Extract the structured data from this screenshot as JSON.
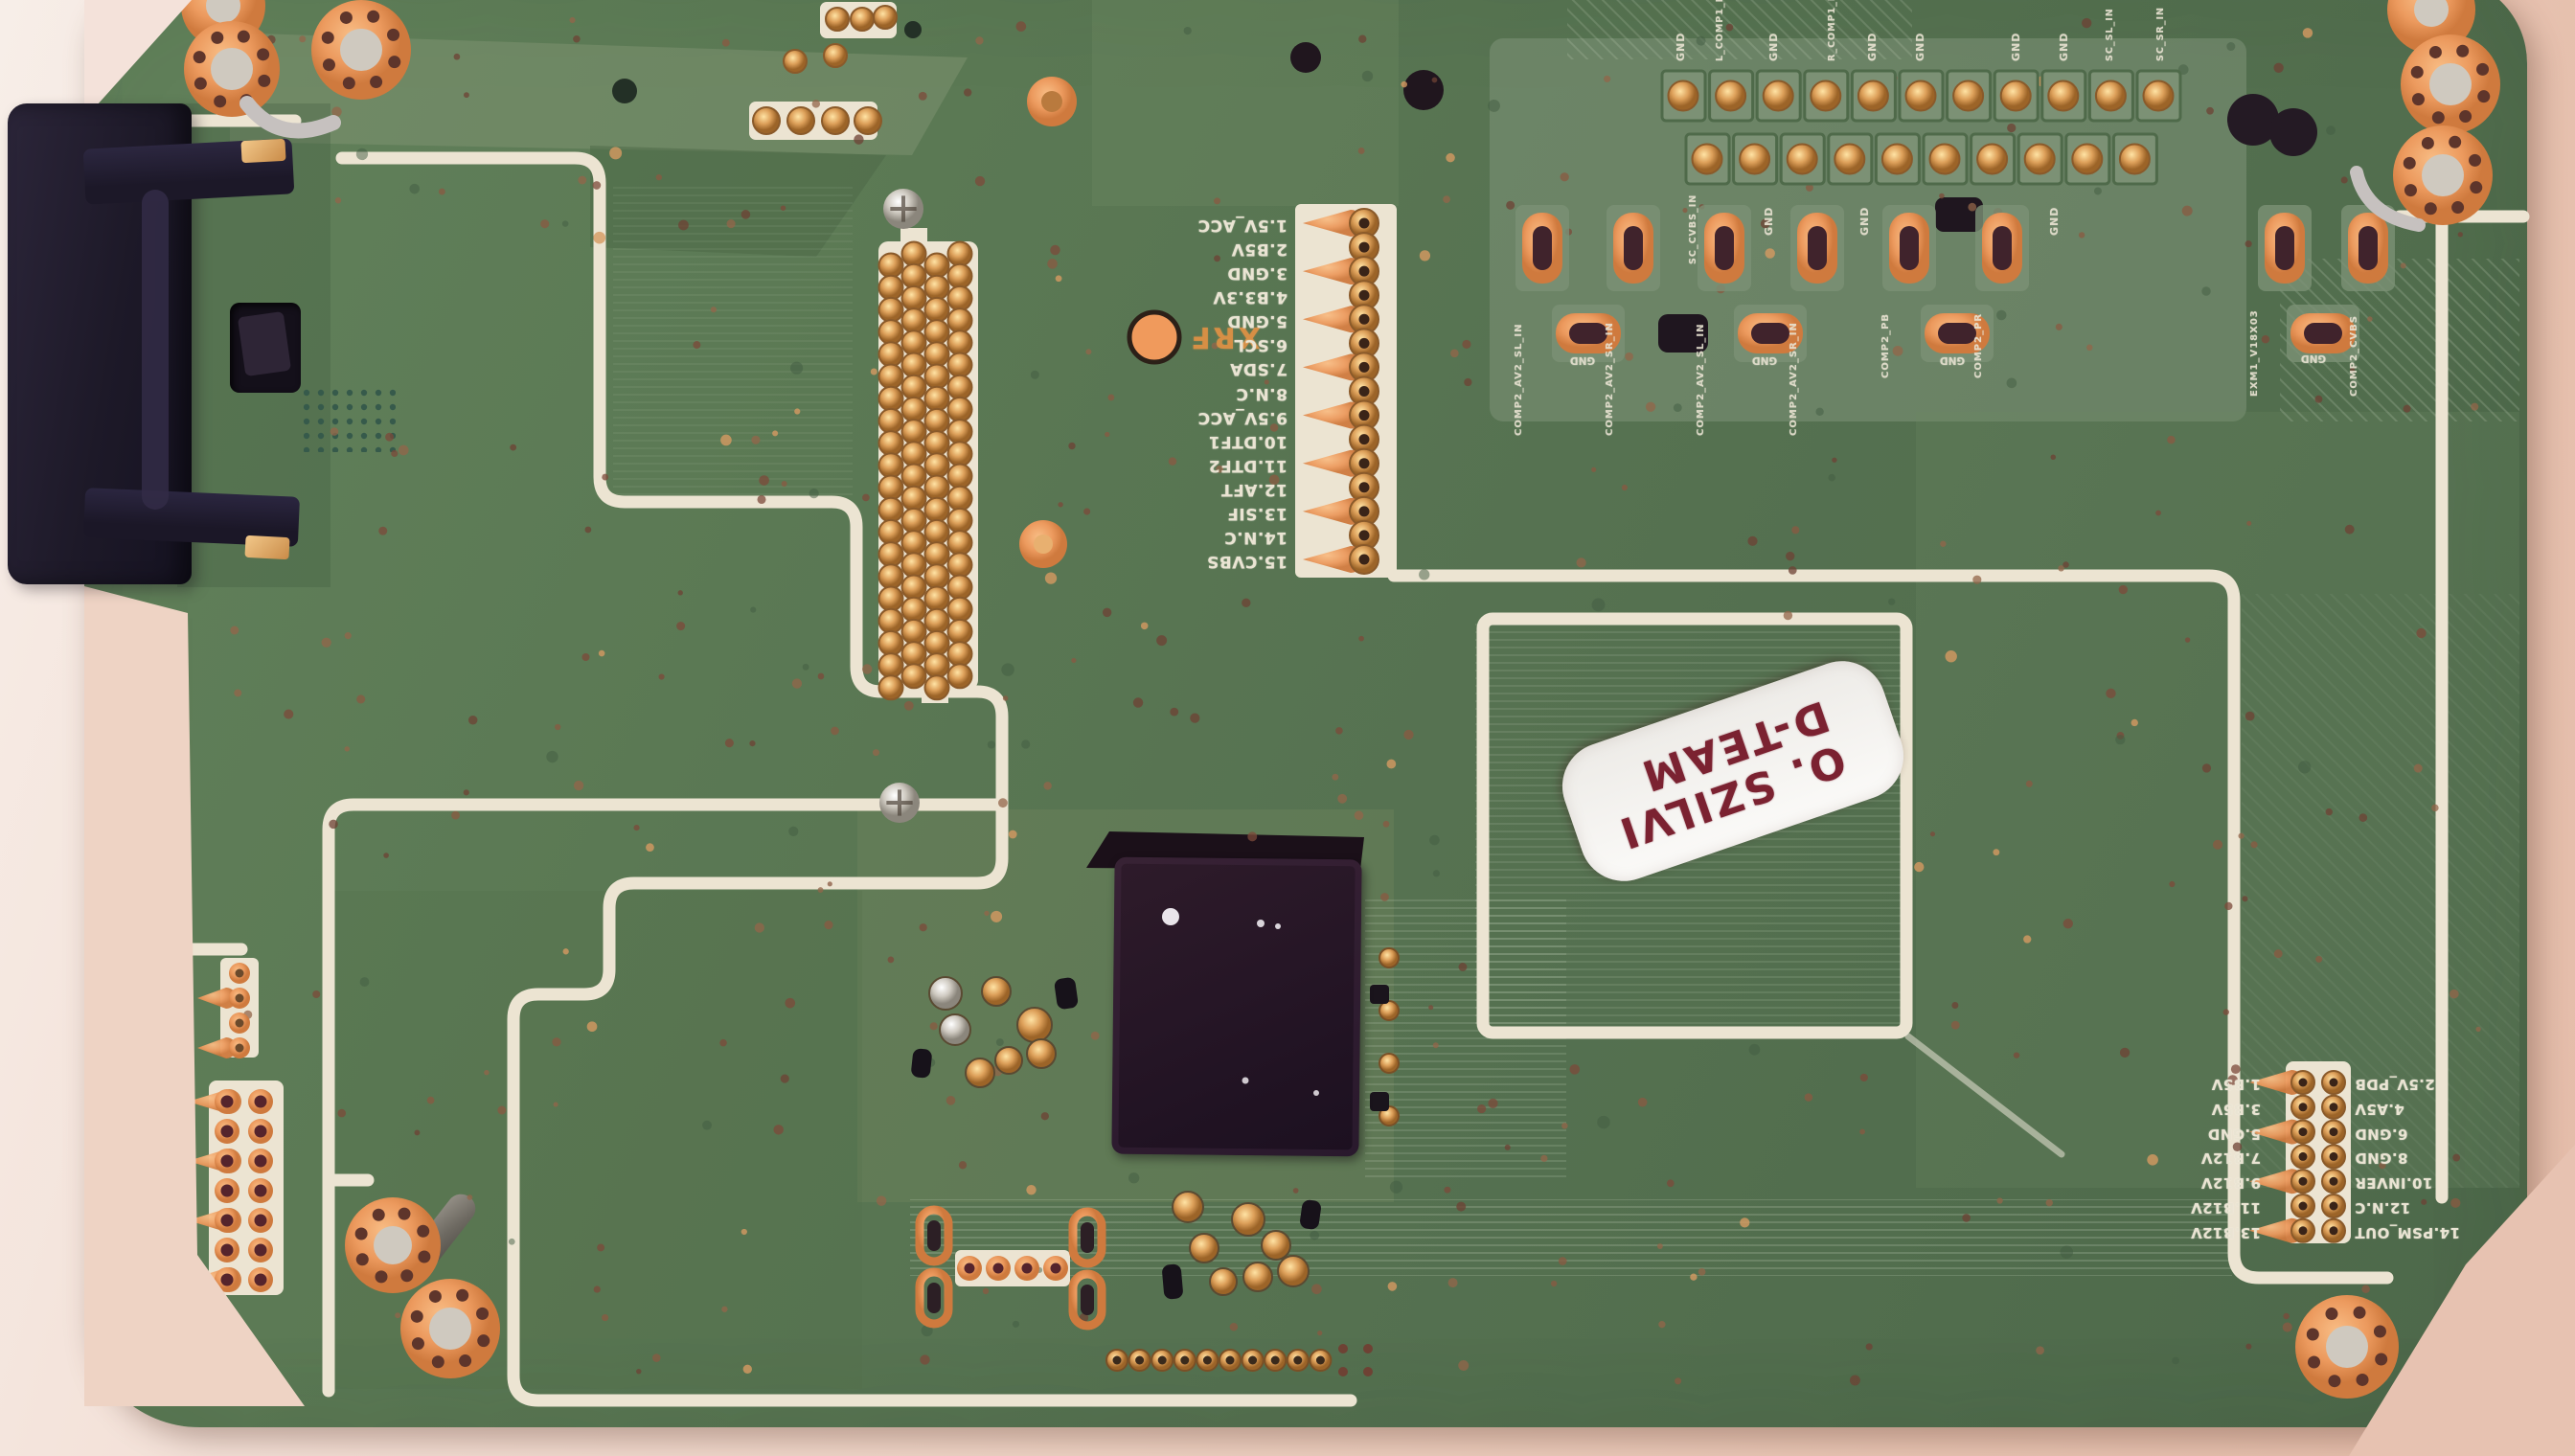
{
  "labels": {
    "xrf": "XRF",
    "version": "EXM1_V18X03"
  },
  "sticker": {
    "line1": "O. SZILVI",
    "line2": "D-TEAM"
  },
  "tuner_header": {
    "pins": [
      "1.5V_ACC",
      "2.B5V",
      "3.GND",
      "4.B3.3V",
      "5.GND",
      "6.SCL",
      "7.SDA",
      "8.N.C",
      "9.5V_ACC",
      "10.DTF1",
      "11.DTF2",
      "12.AFT",
      "13.SIF",
      "14.N.C",
      "15.CVBS"
    ]
  },
  "power_connector": {
    "left": [
      "1.B5V",
      "3.B5V",
      "5.GND",
      "7.B12V",
      "9.B12V",
      "11.B12V",
      "13.B12V"
    ],
    "right": [
      "2.5V_PDB",
      "4.A5V",
      "6.GND",
      "8.GND",
      "10.INVER",
      "12.N.C",
      "14.PSM_OUT"
    ]
  },
  "av_area": {
    "top_long": [
      "L_COMP1_IN",
      "R_COMP1_IN",
      "SC_SL_IN",
      "SC_SR_IN"
    ],
    "top_ticks": [
      "GND",
      "GND",
      "GND",
      "GND",
      "GND",
      "GND"
    ],
    "bottom_long": [
      "SC_CVBS_IN"
    ],
    "bottom_ticks": [
      "GND",
      "GND",
      "GND"
    ],
    "oval_labels": [
      "COMP2_AV2_SL_IN",
      "COMP2_AV2_SR_IN",
      "COMP2_AV2_SL_IN",
      "COMP2_AV2_SR_IN",
      "COMP2_PB",
      "COMP2_PR"
    ],
    "gnd_labels": [
      "GND",
      "GND",
      "GND",
      "GND"
    ],
    "right_edge": [
      "COMP2_CVBS"
    ]
  },
  "colors": {
    "pcb_green": "#587753",
    "silkscreen": "#ece4d2",
    "pad_gold": "#d79a52",
    "pad_orange": "#ef9a5e",
    "table_pink": "#ecd0c2",
    "sticker_text": "#7b2231",
    "chip_black": "#241522"
  }
}
